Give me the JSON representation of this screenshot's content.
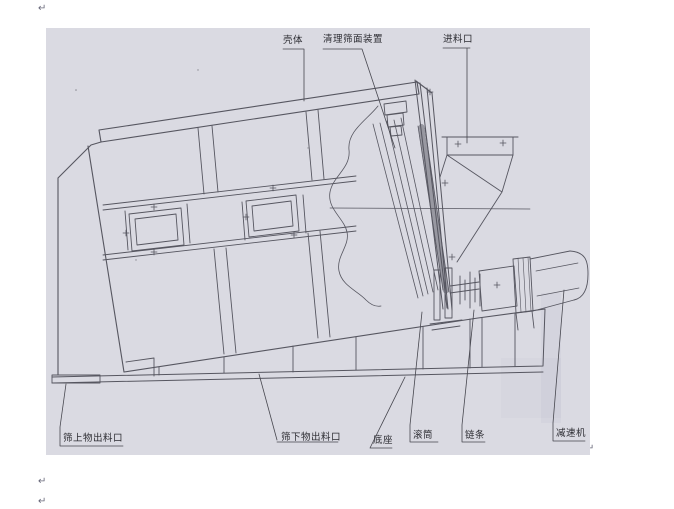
{
  "page": {
    "paragraph_mark": "↵",
    "background_color": "#ffffff"
  },
  "scan": {
    "background_color": "#dadae2",
    "line_color": "#565660",
    "description": "side-view technical drawing of inclined screening machine"
  },
  "labels": {
    "shell": "壳体",
    "cleaner": "清理筛面装置",
    "inlet": "进料口",
    "oversize_outlet": "筛上物出料口",
    "undersize_outlet": "筛下物出料口",
    "base": "底座",
    "drum": "滚筒",
    "chain": "链条",
    "reducer": "减速机"
  }
}
